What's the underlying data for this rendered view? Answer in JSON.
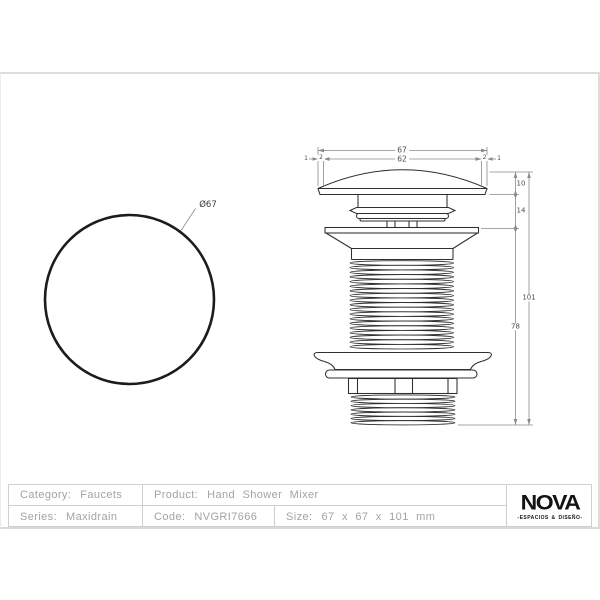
{
  "front_view": {
    "diameter_label": "Ø67"
  },
  "side_view": {
    "dims": {
      "width_total": "67",
      "width_inner": "62",
      "edge_left_outer": "1",
      "edge_left_inner": "2",
      "edge_right_inner": "2",
      "edge_right_outer": "1",
      "cap_height": "10",
      "neck_height": "14",
      "body_height": "78",
      "total_height": "101"
    }
  },
  "spec_table": {
    "category_label": "Category:",
    "category_value": "Faucets",
    "product_label": "Product:",
    "product_value": "Hand Shower Mixer",
    "series_label": "Series:",
    "series_value": "Maxidrain",
    "code_label": "Code:",
    "code_value": "NVGRI7666",
    "size_label": "Size:",
    "size_value": "67 x 67 x 101 mm"
  },
  "brand": {
    "name": "NOVA",
    "tagline": "-ESPACIOS & DISEÑO-"
  }
}
